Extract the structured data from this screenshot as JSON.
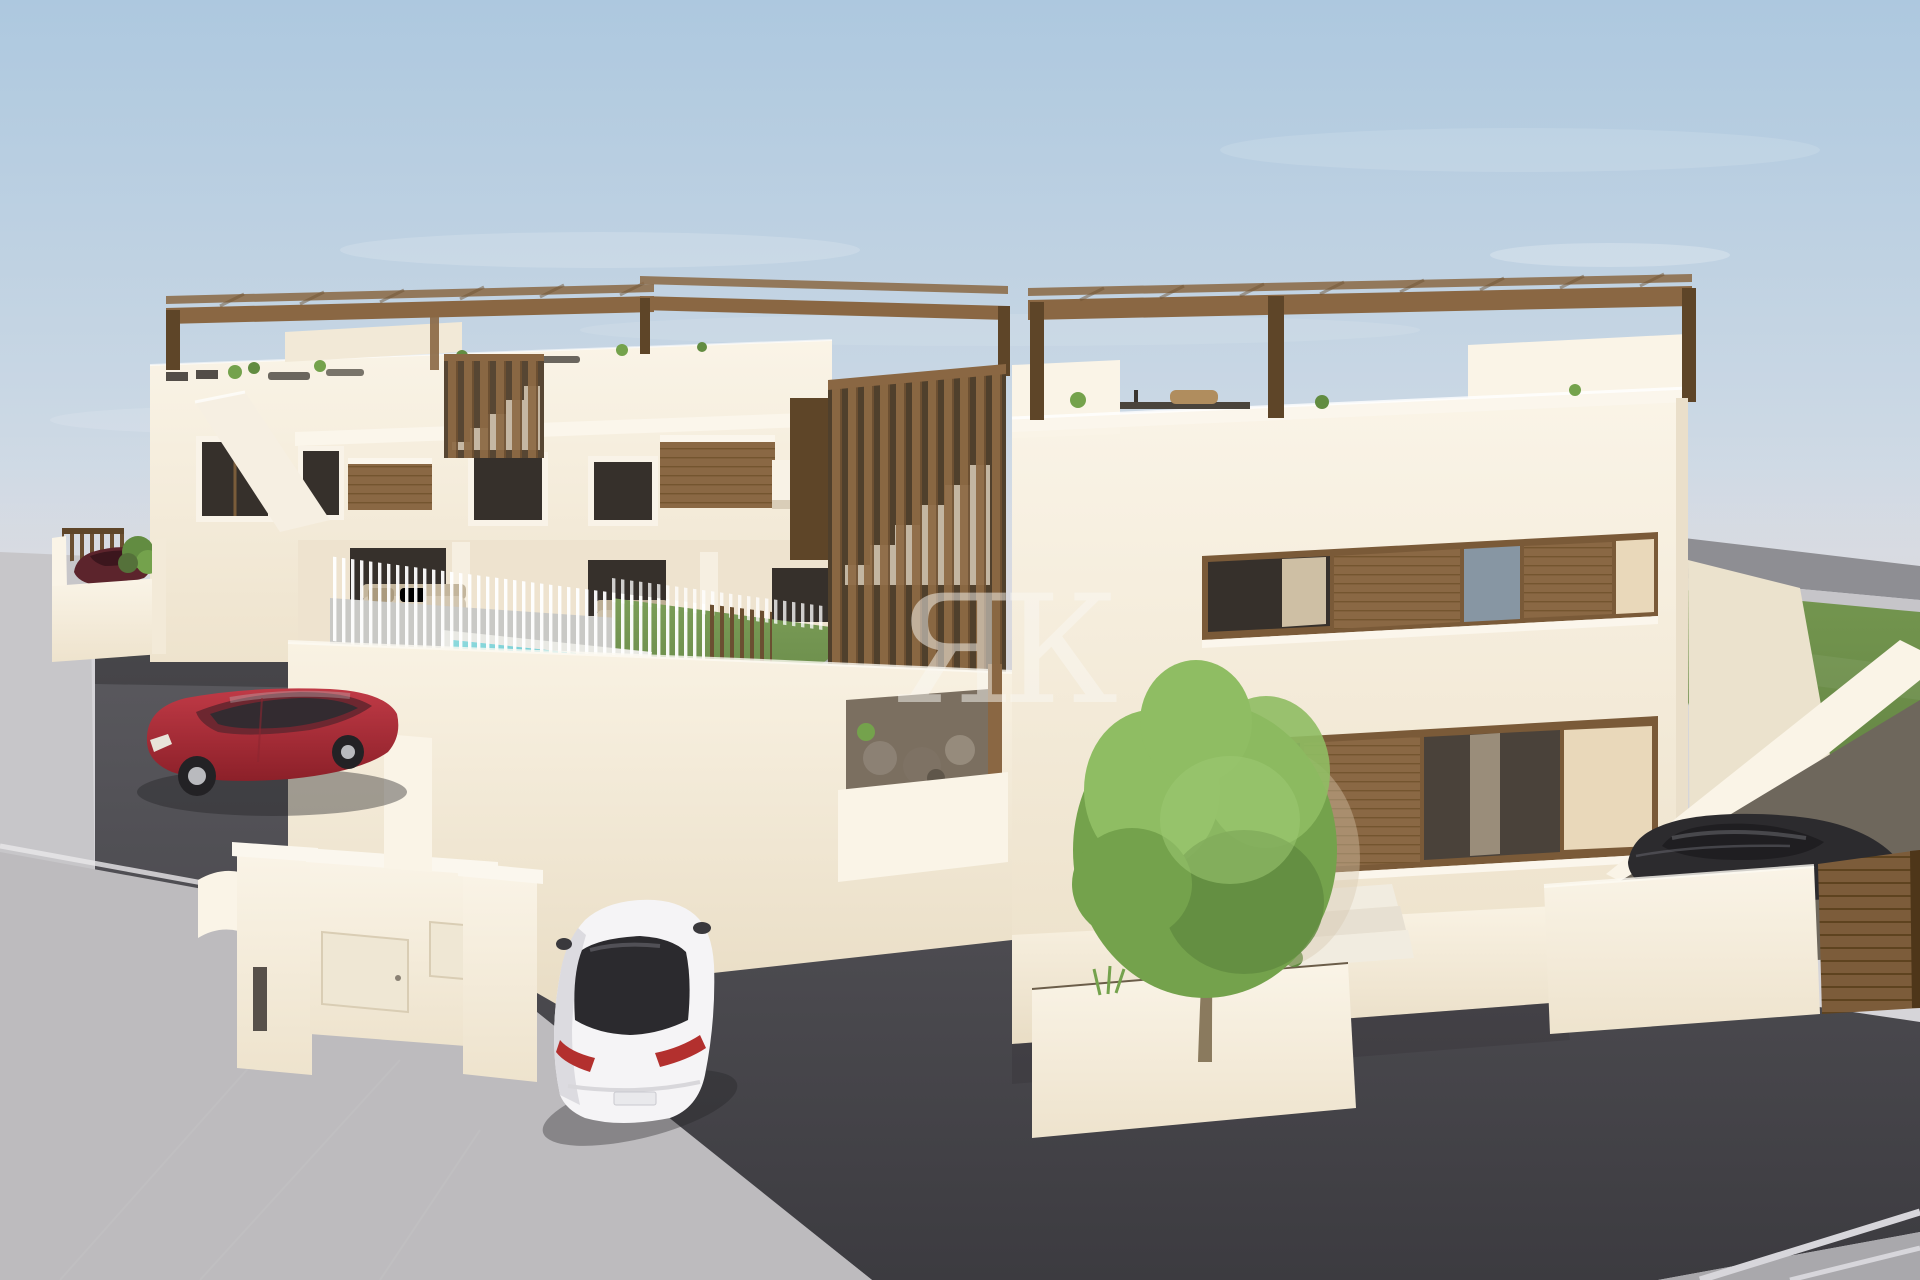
{
  "image": {
    "kind": "3d-architectural-render",
    "subject": "Modern white residential complex with wood accents, swimming pool, cars, lawn and driveway"
  },
  "watermark": {
    "text": "ЯК",
    "color": "#faf8f3",
    "opacity": "0.5"
  },
  "palette": {
    "sky_top": "#adc8df",
    "sky_bottom": "#e0e1e7",
    "haze": "#d9d8dc",
    "ground_far": "#d6d5d9",
    "wall_light": "#faf4e7",
    "wall_mid": "#f3ead8",
    "wall_shadow": "#e7dcc4",
    "wood": "#8a6743",
    "wood_dark": "#5e4528",
    "wood_light": "#a5815a",
    "glass_dark": "#36302b",
    "glass_blue": "#8796a3",
    "glass_warm": "#e9d8ba",
    "pool_light": "#8fdbde",
    "pool_deep": "#46b4c2",
    "lawn_light": "#7b9d57",
    "lawn_dark": "#5f8142",
    "tree_light": "#8fbd63",
    "tree_mid": "#74a24c",
    "tree_dark": "#628c41",
    "asphalt": "#4a494e",
    "paver": "#bdbbbe",
    "sidewalk": "#c7c6c9",
    "road_far": "#8e8e93",
    "curb": "#c6c5c9",
    "path_gray": "#a4a7a6",
    "car_red": "#b02f3c",
    "car_red_dark": "#7e1d27",
    "car_white": "#f5f4f6",
    "car_dark": "#2c2b2e",
    "car_maroon": "#5c242c",
    "taillight": "#b3302e",
    "shadow": "#232225"
  },
  "objects": [
    "sky",
    "clouds",
    "distant road",
    "right lawn",
    "left townhouse block with roof pergolas",
    "wood slat stair tower",
    "swimming pool",
    "pool slat fence",
    "white privacy walls",
    "entrance wall with utility doors",
    "red hatchback car",
    "white sedan car",
    "dark sedan on garage ramp",
    "dark red car in walled courtyard",
    "two-storey house with wood shutter window bands",
    "tree in white planter",
    "entry steps",
    "wood gate",
    "asphalt driveway",
    "paved sidewalk",
    "watermark monogram"
  ]
}
